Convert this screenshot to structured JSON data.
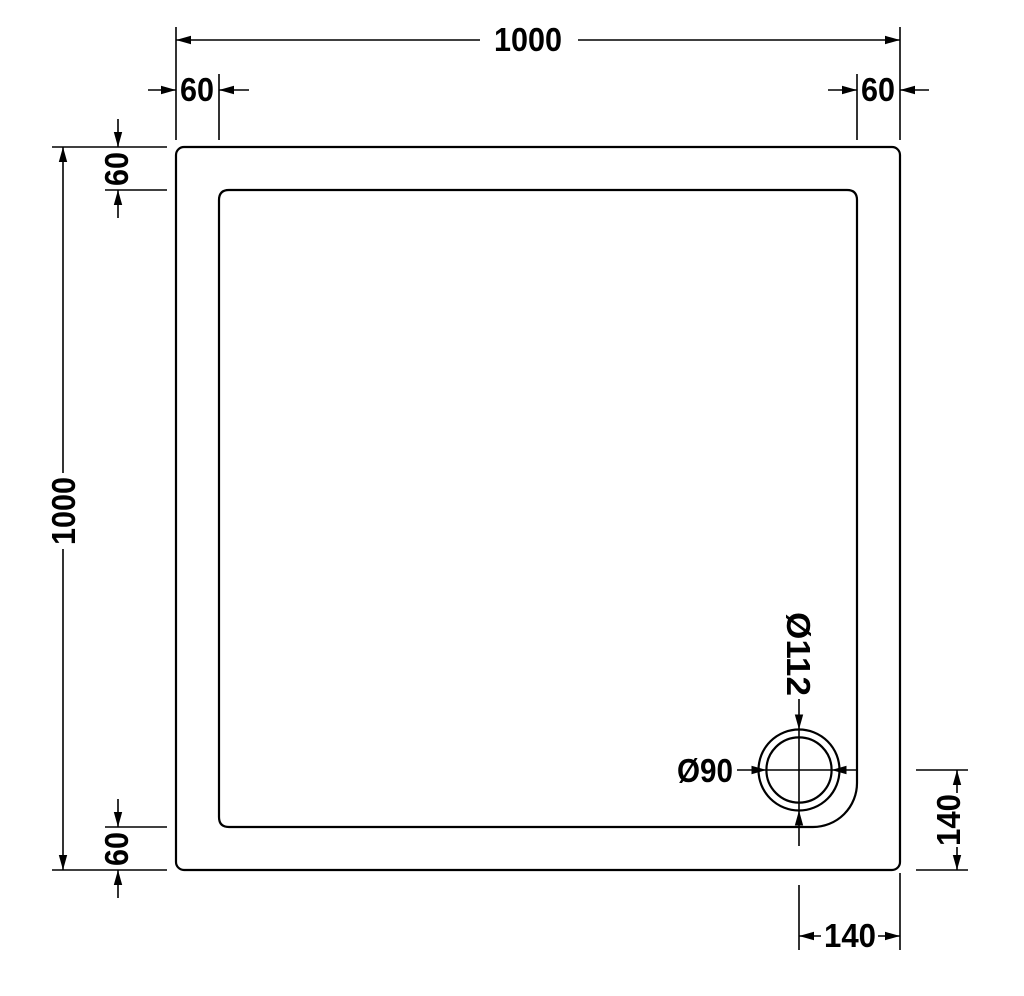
{
  "drawing": {
    "background_color": "#ffffff",
    "line_color": "#000000",
    "labels": {
      "overall_width": "1000",
      "overall_height": "1000",
      "rim_margin_top_left": "60",
      "rim_margin_top_right": "60",
      "rim_margin_left_top": "60",
      "rim_margin_left_bottom": "60",
      "drain_outer_diameter": "Ø112",
      "drain_inner_diameter": "Ø90",
      "drain_offset_from_bottom": "140",
      "drain_offset_from_right": "140"
    }
  }
}
